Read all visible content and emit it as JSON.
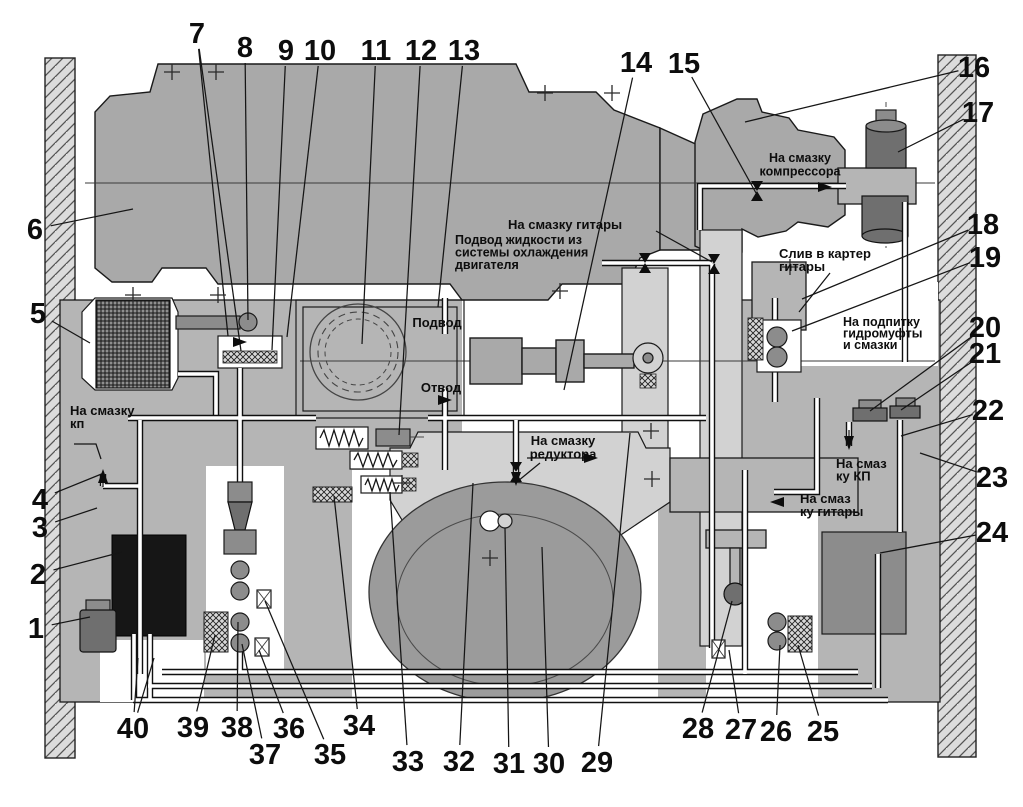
{
  "diagram": {
    "colors": {
      "bg": "#ffffff",
      "wall": "#dcdcdc",
      "metal": "#a9a9a9",
      "housing": "#b5b5b5",
      "light": "#d2d2d2",
      "lighter": "#cbcbcb",
      "dark": "#8c8c8c",
      "darker": "#6f6f6f",
      "tank": "#161616",
      "drum": "#9b9b9b",
      "line": "#111111"
    },
    "labels": [
      {
        "id": "compressor",
        "lines": [
          "На смазку",
          "компрессора"
        ],
        "x": 800,
        "y": 162,
        "lh": 13.5,
        "anchor": "middle",
        "size": "small"
      },
      {
        "id": "guitar_top",
        "lines": [
          "На смазку гитары"
        ],
        "x": 508,
        "y": 229,
        "lh": 13,
        "anchor": "start",
        "size": "normal"
      },
      {
        "id": "coolant",
        "lines": [
          "Подвод жидкости из",
          "системы охлаждения",
          "двигателя"
        ],
        "x": 455,
        "y": 244,
        "lh": 12.5,
        "anchor": "start",
        "size": "small"
      },
      {
        "id": "podvod",
        "lines": [
          "Подвод"
        ],
        "x": 437,
        "y": 327,
        "lh": 13,
        "anchor": "middle",
        "size": "normal"
      },
      {
        "id": "otvod",
        "lines": [
          "Отвод"
        ],
        "x": 441,
        "y": 392,
        "lh": 13,
        "anchor": "middle",
        "size": "normal"
      },
      {
        "id": "sliv",
        "lines": [
          "Слив в картер",
          "гитары"
        ],
        "x": 779,
        "y": 258,
        "lh": 13,
        "anchor": "start",
        "size": "normal"
      },
      {
        "id": "podpitka",
        "lines": [
          "На подпитку",
          "гидромуфты",
          "и смазки"
        ],
        "x": 843,
        "y": 326,
        "lh": 11.5,
        "anchor": "start",
        "size": "small"
      },
      {
        "id": "kp_left",
        "lines": [
          "На смазку",
          "кп"
        ],
        "x": 70,
        "y": 415,
        "lh": 13,
        "anchor": "start",
        "size": "normal"
      },
      {
        "id": "reduktor",
        "lines": [
          "На смазку",
          "редуктора"
        ],
        "x": 563,
        "y": 445,
        "lh": 13.5,
        "anchor": "middle",
        "size": "normal"
      },
      {
        "id": "kp_right",
        "lines": [
          "На смаз",
          "ку КП"
        ],
        "x": 836,
        "y": 468,
        "lh": 12.5,
        "anchor": "start",
        "size": "normal"
      },
      {
        "id": "guitar_right",
        "lines": [
          "На смаз",
          "ку гитары"
        ],
        "x": 800,
        "y": 503,
        "lh": 13,
        "anchor": "start",
        "size": "normal"
      }
    ],
    "callouts": [
      {
        "n": "1",
        "x": 36,
        "y": 638,
        "tx": 90,
        "ty": 617
      },
      {
        "n": "2",
        "x": 38,
        "y": 584,
        "tx": 122,
        "ty": 552
      },
      {
        "n": "3",
        "x": 40,
        "y": 537,
        "tx": 97,
        "ty": 508
      },
      {
        "n": "4",
        "x": 40,
        "y": 509,
        "tx": 104,
        "ty": 473
      },
      {
        "n": "5",
        "x": 38,
        "y": 323,
        "tx": 90,
        "ty": 343
      },
      {
        "n": "6",
        "x": 35,
        "y": 239,
        "tx": 133,
        "ty": 209
      },
      {
        "n": "7",
        "x": 197,
        "y": 43,
        "tx": 228,
        "ty": 336,
        "t2x": 241,
        "t2y": 351
      },
      {
        "n": "8",
        "x": 245,
        "y": 57,
        "tx": 248,
        "ty": 320
      },
      {
        "n": "9",
        "x": 286,
        "y": 60,
        "tx": 272,
        "ty": 350
      },
      {
        "n": "10",
        "x": 320,
        "y": 60,
        "tx": 287,
        "ty": 337
      },
      {
        "n": "11",
        "x": 376,
        "y": 60,
        "tx": 362,
        "ty": 344
      },
      {
        "n": "12",
        "x": 421,
        "y": 60,
        "tx": 399,
        "ty": 435
      },
      {
        "n": "13",
        "x": 464,
        "y": 60,
        "tx": 438,
        "ty": 307
      },
      {
        "n": "14",
        "x": 636,
        "y": 72,
        "tx": 564,
        "ty": 390
      },
      {
        "n": "15",
        "x": 684,
        "y": 73,
        "tx": 756,
        "ty": 193
      },
      {
        "n": "16",
        "x": 974,
        "y": 77,
        "tx": 745,
        "ty": 122
      },
      {
        "n": "17",
        "x": 978,
        "y": 122,
        "tx": 898,
        "ty": 152
      },
      {
        "n": "18",
        "x": 983,
        "y": 234,
        "tx": 802,
        "ty": 299
      },
      {
        "n": "19",
        "x": 985,
        "y": 267,
        "tx": 792,
        "ty": 331
      },
      {
        "n": "20",
        "x": 985,
        "y": 337,
        "tx": 870,
        "ty": 411
      },
      {
        "n": "21",
        "x": 985,
        "y": 363,
        "tx": 901,
        "ty": 410
      },
      {
        "n": "22",
        "x": 988,
        "y": 420,
        "tx": 901,
        "ty": 436
      },
      {
        "n": "23",
        "x": 992,
        "y": 487,
        "tx": 920,
        "ty": 453
      },
      {
        "n": "24",
        "x": 992,
        "y": 542,
        "tx": 880,
        "ty": 553
      },
      {
        "n": "25",
        "x": 823,
        "y": 741,
        "tx": 798,
        "ty": 645
      },
      {
        "n": "26",
        "x": 776,
        "y": 741,
        "tx": 780,
        "ty": 645
      },
      {
        "n": "27",
        "x": 741,
        "y": 739,
        "tx": 729,
        "ty": 650
      },
      {
        "n": "28",
        "x": 698,
        "y": 738,
        "tx": 732,
        "ty": 601
      },
      {
        "n": "29",
        "x": 597,
        "y": 772,
        "tx": 630,
        "ty": 433
      },
      {
        "n": "30",
        "x": 549,
        "y": 773,
        "tx": 542,
        "ty": 547
      },
      {
        "n": "31",
        "x": 509,
        "y": 773,
        "tx": 505,
        "ty": 528
      },
      {
        "n": "32",
        "x": 459,
        "y": 771,
        "tx": 473,
        "ty": 483
      },
      {
        "n": "33",
        "x": 408,
        "y": 771,
        "tx": 390,
        "ty": 492
      },
      {
        "n": "34",
        "x": 359,
        "y": 735,
        "tx": 334,
        "ty": 496
      },
      {
        "n": "35",
        "x": 330,
        "y": 764,
        "tx": 265,
        "ty": 601
      },
      {
        "n": "36",
        "x": 289,
        "y": 738,
        "tx": 259,
        "ty": 650
      },
      {
        "n": "37",
        "x": 265,
        "y": 764,
        "tx": 242,
        "ty": 644
      },
      {
        "n": "38",
        "x": 237,
        "y": 737,
        "tx": 238,
        "ty": 622
      },
      {
        "n": "39",
        "x": 193,
        "y": 737,
        "tx": 215,
        "ty": 635
      },
      {
        "n": "40",
        "x": 133,
        "y": 738,
        "tx": 138,
        "ty": 658,
        "t2x": 154,
        "t2y": 658
      }
    ],
    "label_leaders": [
      {
        "id": "guitar-top-leader",
        "pts": [
          [
            656,
            231
          ],
          [
            712,
            262
          ]
        ]
      },
      {
        "id": "sliv-leader",
        "pts": [
          [
            830,
            273
          ],
          [
            799,
            312
          ]
        ]
      },
      {
        "id": "kp-left-hook",
        "pts": [
          [
            74,
            444
          ],
          [
            96,
            444
          ],
          [
            101,
            459
          ]
        ]
      },
      {
        "id": "kp-left-stem",
        "pts": [
          [
            103,
            487
          ],
          [
            103,
            472
          ]
        ]
      },
      {
        "id": "reduktor-span",
        "pts": [
          [
            527,
            458
          ],
          [
            594,
            458
          ]
        ]
      },
      {
        "id": "reduktor-bend",
        "pts": [
          [
            540,
            463
          ],
          [
            518,
            481
          ]
        ]
      },
      {
        "id": "kp-right-stem",
        "pts": [
          [
            849,
            430
          ],
          [
            849,
            444
          ]
        ]
      }
    ],
    "flow_markers": [
      {
        "type": "arrow",
        "dir": "right",
        "x": 247,
        "y": 342
      },
      {
        "type": "arrow",
        "dir": "right",
        "x": 452,
        "y": 400
      },
      {
        "type": "arrow",
        "dir": "up",
        "x": 103,
        "y": 469
      },
      {
        "type": "arrow",
        "dir": "down",
        "x": 516,
        "y": 486
      },
      {
        "type": "arrow",
        "dir": "left",
        "x": 770,
        "y": 502
      },
      {
        "type": "arrow",
        "dir": "down",
        "x": 849,
        "y": 450
      },
      {
        "type": "arrow",
        "dir": "right",
        "x": 832,
        "y": 187
      },
      {
        "type": "arrow",
        "dir": "right",
        "x": 598,
        "y": 458
      },
      {
        "type": "bowtie",
        "x": 757,
        "y": 191
      },
      {
        "type": "bowtie",
        "x": 645,
        "y": 263
      },
      {
        "type": "bowtie",
        "x": 714,
        "y": 264
      },
      {
        "type": "bowtie",
        "x": 516,
        "y": 472
      }
    ],
    "plus_marks": [
      [
        172,
        72
      ],
      [
        216,
        72
      ],
      [
        545,
        93
      ],
      [
        612,
        93
      ],
      [
        133,
        295
      ],
      [
        218,
        295
      ],
      [
        560,
        291
      ],
      [
        790,
        267
      ],
      [
        402,
        483
      ],
      [
        652,
        479
      ],
      [
        490,
        558
      ],
      [
        651,
        431
      ]
    ]
  }
}
